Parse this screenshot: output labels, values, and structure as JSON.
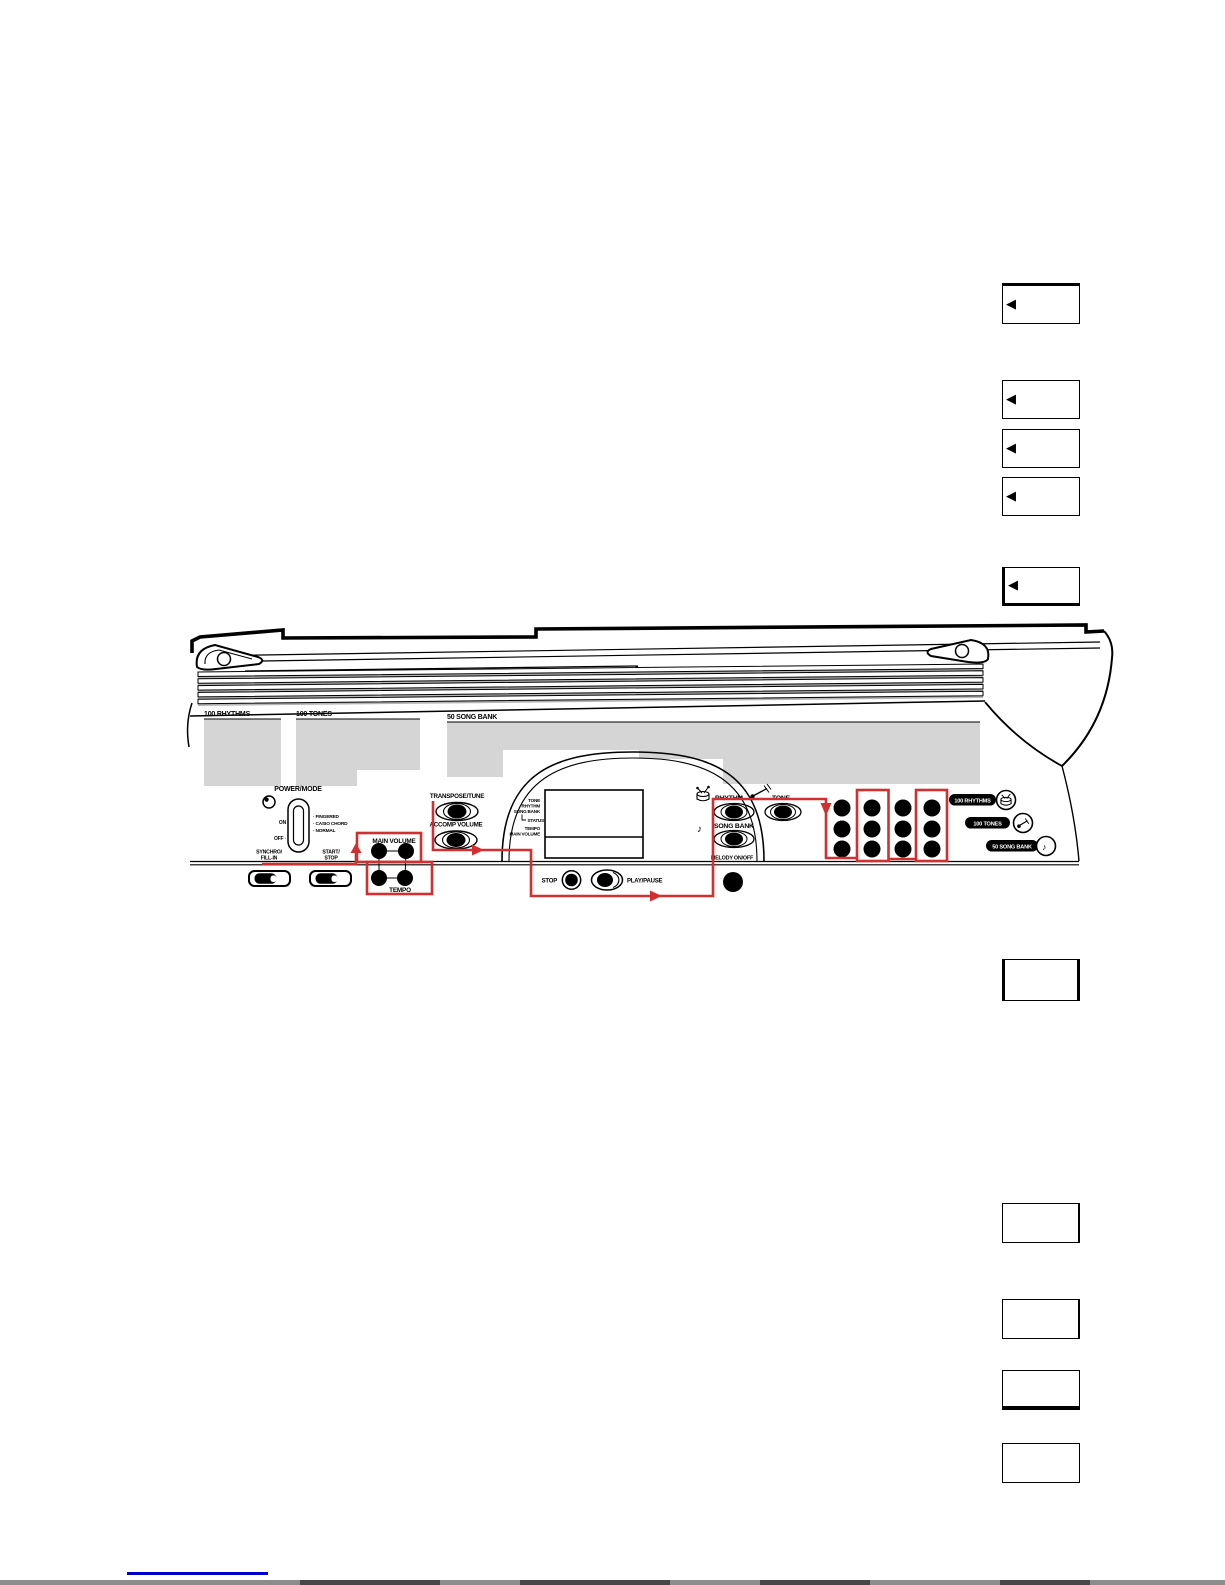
{
  "colors": {
    "accent_red": "#d03030",
    "panel_gray": "#d5d5d5",
    "link_blue": "#0000cc",
    "page_bg": "#ffffff"
  },
  "callouts": {
    "arrow_glyph": "◀"
  },
  "diagram": {
    "sections": {
      "rhythms": "100 RHYTHMS",
      "tones": "100 TONES",
      "song_bank": "50 SONG BANK"
    },
    "power": {
      "title": "POWER/MODE",
      "on": "ON",
      "off": "OFF ·",
      "modes": [
        "· FINGERED",
        "· CASIO CHORD",
        "· NORMAL"
      ]
    },
    "left_buttons": {
      "synchro": [
        "SYNCHRO/",
        "FILL-IN"
      ],
      "start_stop": [
        "START/",
        "STOP"
      ]
    },
    "volume": {
      "main": "MAIN VOLUME",
      "tempo": "TEMPO"
    },
    "tune": {
      "transpose": "TRANSPOSE/TUNE",
      "accomp": "ACCOMP VOLUME"
    },
    "display": {
      "labels": [
        "TONE",
        "RHYTHM",
        "SONG BANK"
      ],
      "status": "STATUS",
      "tempo": "TEMPO",
      "main_volume": "MAIN VOLUME"
    },
    "transport": {
      "stop": "STOP",
      "play_pause": "PLAY/PAUSE"
    },
    "selectors": {
      "rhythm": "RHYTHM",
      "tone": "TONE",
      "song_bank": "SONG BANK",
      "melody": "MELODY ON/OFF"
    },
    "pills": {
      "rhythms": "100 RHYTHMS",
      "tones": "100 TONES",
      "song_bank": "50 SONG BANK"
    },
    "glyphs": {
      "note": "♪"
    }
  }
}
